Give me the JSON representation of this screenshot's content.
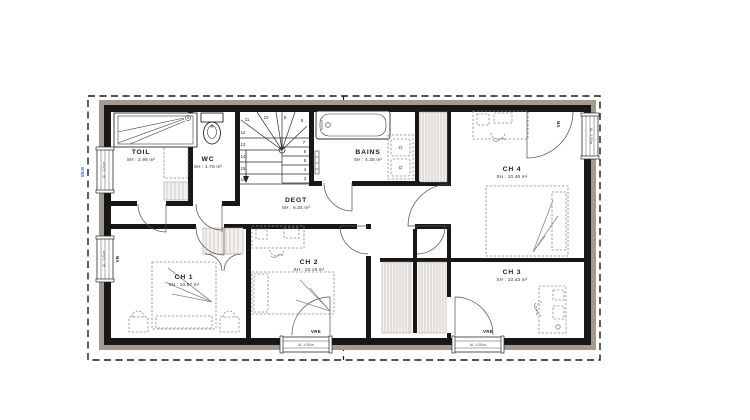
{
  "plan": {
    "title": "floor-plan-upper-storey",
    "rooms": [
      {
        "id": "toil",
        "name": "TOIL",
        "area": "SH : 2.98 m²"
      },
      {
        "id": "wc",
        "name": "WC",
        "area": "SH : 1.78 m²"
      },
      {
        "id": "degt",
        "name": "DEGT",
        "area": "SH : 6.34 m²"
      },
      {
        "id": "bains",
        "name": "BAINS",
        "area": "SH : 4.35 m²"
      },
      {
        "id": "ch1",
        "name": "CH 1",
        "area": "SH : 10.67 m²"
      },
      {
        "id": "ch2",
        "name": "CH 2",
        "area": "SH : 10.19 m²"
      },
      {
        "id": "ch3",
        "name": "CH 3",
        "area": "SH : 10.43 m²"
      },
      {
        "id": "ch4",
        "name": "CH 4",
        "area": "SH : 10.46 m²"
      }
    ],
    "stairs": {
      "numbers": [
        "3",
        "4",
        "5",
        "6",
        "7",
        "8",
        "9",
        "10",
        "11",
        "12",
        "13",
        "14",
        "15",
        "16"
      ]
    },
    "windows": {
      "shutter_bottom_left": "VRE",
      "shutter_bottom_right": "VRE",
      "shutter_left": "VR",
      "shutter_right": "VR",
      "sill_left_top": "AL : 1.20 m",
      "sill_left_bottom": "AL : 1.20 m",
      "sill_right": "AL : 1.00 m",
      "sill_bottom_left": "AL : 0.50 m",
      "sill_bottom_right": "AL : 0.50 m"
    },
    "annotations": {
      "downpipe": "SB40"
    },
    "colors": {
      "wall": "#171717",
      "insulation": "#a39a92",
      "furniture": "#8a8a8a",
      "accent_blue": "#4a6fd4"
    }
  }
}
